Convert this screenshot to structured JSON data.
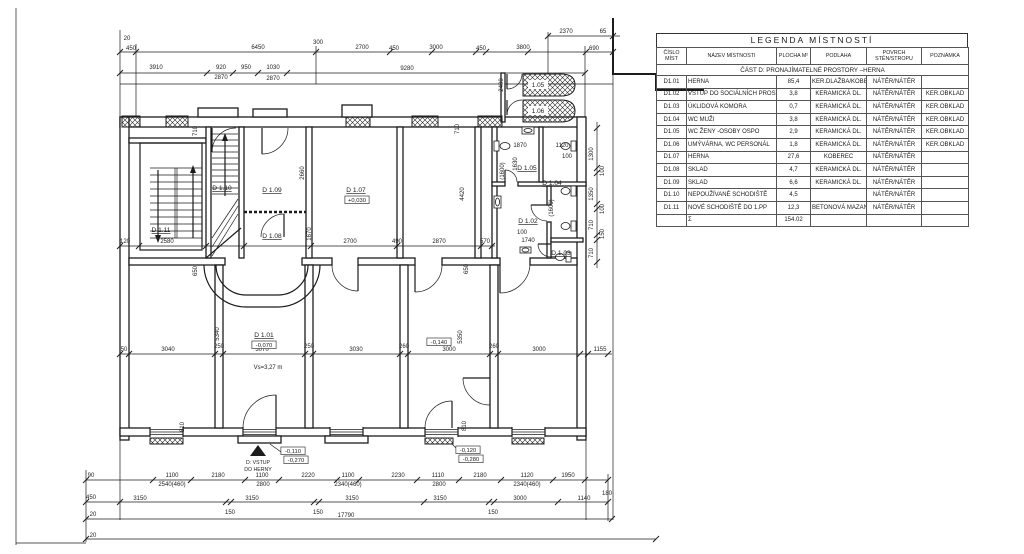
{
  "legend": {
    "title": "LEGENDA MÍSTNOSTÍ",
    "columns": [
      "ČÍSLO MÍST",
      "NÁZEV MÍSTNOSTI",
      "PLOCHA M²",
      "PODLAHA",
      "POVRCH STĚN/STROPU",
      "POZNÁMKA"
    ],
    "section": "ČÁST D: PRONAJÍMATELNÉ PROSTORY –HERNA",
    "rows": [
      [
        "D1.01",
        "HERNA",
        "85,4",
        "KER.DLAŽBA/KOBEREC",
        "NÁTĚR/NÁTĚR",
        ""
      ],
      [
        "D1.02",
        "VSTUP DO SOCIÁLNÍCH PROSTOR",
        "3,8",
        "KERAMICKÁ DL.",
        "NÁTĚR/NÁTĚR",
        "KER.OBKLAD"
      ],
      [
        "D1.03",
        "ÚKLIDOVÁ KOMORA",
        "0,7",
        "KERAMICKÁ DL.",
        "NÁTĚR/NÁTĚR",
        "KER.OBKLAD"
      ],
      [
        "D1.04",
        "WC MUŽI",
        "3,8",
        "KERAMICKÁ DL.",
        "NÁTĚR/NÁTĚR",
        "KER.OBKLAD"
      ],
      [
        "D1.05",
        "WC ŽENY -OSOBY OSPO",
        "2,9",
        "KERAMICKÁ DL.",
        "NÁTĚR/NÁTĚR",
        "KER.OBKLAD"
      ],
      [
        "D1.06",
        "UMÝVÁRNA, WC PERSONÁL",
        "1,8",
        "KERAMICKÁ DL.",
        "NÁTĚR/NÁTĚR",
        "KER.OBKLAD"
      ],
      [
        "D1.07",
        "HERNA",
        "27,6",
        "KOBEREC",
        "NÁTĚR/NÁTĚR",
        ""
      ],
      [
        "D1.08",
        "SKLAD",
        "4,7",
        "KERAMICKÁ DL.",
        "NÁTĚR/NÁTĚR",
        ""
      ],
      [
        "D1.09",
        "SKLAD",
        "6,6",
        "KERAMICKÁ DL.",
        "NÁTĚR/NÁTĚR",
        ""
      ],
      [
        "D1.10",
        "NEPOUŽÍVANÉ SCHODIŠTĚ",
        "4,5",
        "",
        "NÁTĚR/NÁTĚR",
        ""
      ],
      [
        "D1.11",
        "NOVÉ SCHODIŠTĚ DO 1.PP",
        "12,3",
        "BETONOVÁ MAZANINA",
        "NÁTĚR/NÁTĚR",
        ""
      ],
      [
        "",
        "Σ",
        "154.02",
        "",
        "",
        ""
      ]
    ]
  },
  "plan": {
    "room_labels": [
      {
        "t": "D 1.11",
        "x": 161,
        "y": 232
      },
      {
        "t": "D 1.10",
        "x": 222,
        "y": 190
      },
      {
        "t": "D 1.09",
        "x": 272,
        "y": 192
      },
      {
        "t": "D 1.08",
        "x": 272,
        "y": 238
      },
      {
        "t": "D 1.07",
        "x": 356,
        "y": 192
      },
      {
        "t": "D 1.01",
        "x": 264,
        "y": 337
      },
      {
        "t": "D 1.05",
        "x": 527,
        "y": 170
      },
      {
        "t": "D 1.04",
        "x": 552,
        "y": 185
      },
      {
        "t": "D 1.02",
        "x": 528,
        "y": 223
      },
      {
        "t": "D 1.03",
        "x": 561,
        "y": 255
      }
    ],
    "ramp_labels": [
      {
        "t": "1.05",
        "x": 538,
        "y": 87
      },
      {
        "t": "1.06",
        "x": 538,
        "y": 113
      }
    ],
    "level_boxes": [
      {
        "t": "+0,030",
        "x": 357,
        "y": 202
      },
      {
        "t": "-0,070",
        "x": 264,
        "y": 347
      },
      {
        "t": "-0,140",
        "x": 439,
        "y": 344
      },
      {
        "t": "-0,110",
        "x": 293,
        "y": 453
      },
      {
        "t": "-0,270",
        "x": 296,
        "y": 462
      },
      {
        "t": "-0,120",
        "x": 468,
        "y": 452
      },
      {
        "t": "-0,280",
        "x": 471,
        "y": 461
      }
    ],
    "notes": [
      {
        "t": "Vs=3,27 m",
        "x": 268,
        "y": 369
      },
      {
        "t": "D: VSTUP",
        "x": 258,
        "y": 464,
        "cls": "tiny"
      },
      {
        "t": "DO HERNY",
        "x": 258,
        "y": 471,
        "cls": "tiny"
      }
    ],
    "dim_labels": [
      {
        "t": "20",
        "x": 127,
        "y": 40
      },
      {
        "t": "450",
        "x": 131,
        "y": 50
      },
      {
        "t": "6450",
        "x": 258,
        "y": 49
      },
      {
        "t": "300",
        "x": 318,
        "y": 44
      },
      {
        "t": "2700",
        "x": 362,
        "y": 49
      },
      {
        "t": "450",
        "x": 394,
        "y": 50
      },
      {
        "t": "3000",
        "x": 436,
        "y": 49
      },
      {
        "t": "450",
        "x": 481,
        "y": 50
      },
      {
        "t": "3800",
        "x": 523,
        "y": 49
      },
      {
        "t": "690",
        "x": 594,
        "y": 50
      },
      {
        "t": "2370",
        "x": 566,
        "y": 33
      },
      {
        "t": "65",
        "x": 603,
        "y": 33
      },
      {
        "t": "3910",
        "x": 156,
        "y": 69
      },
      {
        "t": "920",
        "x": 221,
        "y": 69
      },
      {
        "t": "950",
        "x": 246,
        "y": 69
      },
      {
        "t": "1030",
        "x": 273,
        "y": 69
      },
      {
        "t": "9280",
        "x": 407,
        "y": 70
      },
      {
        "t": "2870",
        "x": 221,
        "y": 79
      },
      {
        "t": "2870",
        "x": 273,
        "y": 80
      },
      {
        "t": "710",
        "x": 197,
        "y": 131,
        "r": -90
      },
      {
        "t": "710",
        "x": 459,
        "y": 129,
        "r": -90
      },
      {
        "t": "2400",
        "x": 503,
        "y": 85,
        "r": -90
      },
      {
        "t": "2660",
        "x": 304,
        "y": 173,
        "r": -90
      },
      {
        "t": "1670",
        "x": 311,
        "y": 234,
        "r": -90
      },
      {
        "t": "4420",
        "x": 464,
        "y": 194,
        "r": -90
      },
      {
        "t": "(1600)",
        "x": 504,
        "y": 171,
        "r": -90
      },
      {
        "t": "1630",
        "x": 517,
        "y": 164,
        "r": -90
      },
      {
        "t": "(1600)",
        "x": 553,
        "y": 208,
        "r": -90
      },
      {
        "t": "1870",
        "x": 520,
        "y": 147
      },
      {
        "t": "1120",
        "x": 562,
        "y": 147
      },
      {
        "t": "100",
        "x": 567,
        "y": 158
      },
      {
        "t": "100",
        "x": 522,
        "y": 234
      },
      {
        "t": "1740",
        "x": 528,
        "y": 242
      },
      {
        "t": "120",
        "x": 125,
        "y": 243
      },
      {
        "t": "2580",
        "x": 167,
        "y": 243
      },
      {
        "t": "2700",
        "x": 350,
        "y": 243
      },
      {
        "t": "490",
        "x": 397,
        "y": 243
      },
      {
        "t": "2870",
        "x": 439,
        "y": 243
      },
      {
        "t": "570",
        "x": 485,
        "y": 243
      },
      {
        "t": "650",
        "x": 197,
        "y": 271,
        "r": -90
      },
      {
        "t": "650",
        "x": 468,
        "y": 269,
        "r": -90
      },
      {
        "t": "5340",
        "x": 219,
        "y": 334,
        "r": -90
      },
      {
        "t": "5350",
        "x": 462,
        "y": 337,
        "r": -90
      },
      {
        "t": "50",
        "x": 124,
        "y": 351
      },
      {
        "t": "3040",
        "x": 168,
        "y": 351
      },
      {
        "t": "250",
        "x": 219,
        "y": 348
      },
      {
        "t": "3070",
        "x": 262,
        "y": 351
      },
      {
        "t": "250",
        "x": 309,
        "y": 348
      },
      {
        "t": "3030",
        "x": 356,
        "y": 351
      },
      {
        "t": "260",
        "x": 404,
        "y": 348
      },
      {
        "t": "3000",
        "x": 449,
        "y": 351
      },
      {
        "t": "260",
        "x": 494,
        "y": 348
      },
      {
        "t": "3000",
        "x": 539,
        "y": 351
      },
      {
        "t": "1155",
        "x": 600,
        "y": 351
      },
      {
        "t": "810",
        "x": 184,
        "y": 427,
        "r": -90
      },
      {
        "t": "810",
        "x": 466,
        "y": 426,
        "r": -90
      },
      {
        "t": "90",
        "x": 91,
        "y": 477
      },
      {
        "t": "1100",
        "x": 172,
        "y": 477
      },
      {
        "t": "2180",
        "x": 218,
        "y": 477
      },
      {
        "t": "1100",
        "x": 262,
        "y": 477
      },
      {
        "t": "2220",
        "x": 308,
        "y": 477
      },
      {
        "t": "1100",
        "x": 348,
        "y": 477
      },
      {
        "t": "2230",
        "x": 398,
        "y": 477
      },
      {
        "t": "1110",
        "x": 438,
        "y": 477
      },
      {
        "t": "2180",
        "x": 480,
        "y": 477
      },
      {
        "t": "1120",
        "x": 527,
        "y": 477
      },
      {
        "t": "1950",
        "x": 568,
        "y": 477
      },
      {
        "t": "2540(460)",
        "x": 172,
        "y": 486
      },
      {
        "t": "2800",
        "x": 263,
        "y": 486
      },
      {
        "t": "2340(460)",
        "x": 348,
        "y": 486
      },
      {
        "t": "2800",
        "x": 439,
        "y": 486
      },
      {
        "t": "2340(460)",
        "x": 527,
        "y": 486
      },
      {
        "t": "180",
        "x": 607,
        "y": 495
      },
      {
        "t": "450",
        "x": 91,
        "y": 499
      },
      {
        "t": "3150",
        "x": 140,
        "y": 500
      },
      {
        "t": "3150",
        "x": 252,
        "y": 500
      },
      {
        "t": "3150",
        "x": 352,
        "y": 500
      },
      {
        "t": "3150",
        "x": 440,
        "y": 500
      },
      {
        "t": "3000",
        "x": 520,
        "y": 500
      },
      {
        "t": "1140",
        "x": 584,
        "y": 500
      },
      {
        "t": "150",
        "x": 230,
        "y": 514
      },
      {
        "t": "150",
        "x": 318,
        "y": 514
      },
      {
        "t": "150",
        "x": 493,
        "y": 514
      },
      {
        "t": "20",
        "x": 93,
        "y": 516
      },
      {
        "t": "17790",
        "x": 346,
        "y": 517
      },
      {
        "t": "20",
        "x": 93,
        "y": 537
      },
      {
        "t": "1300",
        "x": 593,
        "y": 154,
        "r": -90
      },
      {
        "t": "100",
        "x": 604,
        "y": 171,
        "r": -90
      },
      {
        "t": "1350",
        "x": 593,
        "y": 194,
        "r": -90
      },
      {
        "t": "100",
        "x": 604,
        "y": 209,
        "r": -90
      },
      {
        "t": "710",
        "x": 593,
        "y": 225,
        "r": -90
      },
      {
        "t": "150",
        "x": 604,
        "y": 234,
        "r": -90
      },
      {
        "t": "710",
        "x": 593,
        "y": 253,
        "r": -90
      }
    ]
  }
}
